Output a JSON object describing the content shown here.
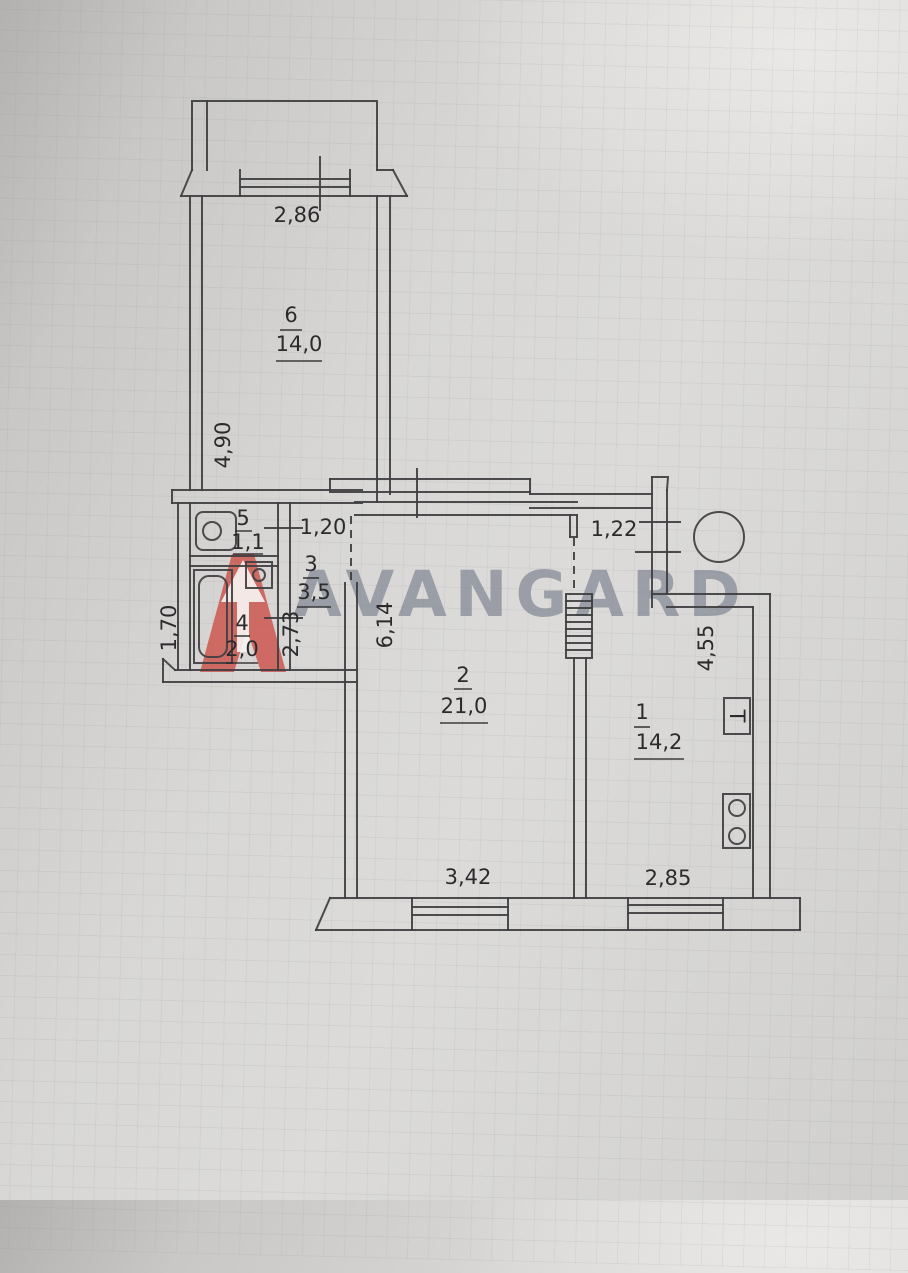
{
  "watermark": {
    "brand": "AVANGARD",
    "brand_color": "#7d8490",
    "logo": "avangard-a-arrow-logo",
    "logo_color": "#cb4b42"
  },
  "rooms": {
    "r1": {
      "number": "1",
      "area": "14,2"
    },
    "r2": {
      "number": "2",
      "area": "21,0"
    },
    "r3": {
      "number": "3",
      "area": "3,5"
    },
    "r4": {
      "number": "4",
      "area": "2,0"
    },
    "r5": {
      "number": "5",
      "area": "1,1"
    },
    "r6": {
      "number": "6",
      "area": "14,0"
    }
  },
  "dimensions": {
    "balcony_width": "2,86",
    "room6_depth": "4,90",
    "hall_width": "1,20",
    "hall_depth": "2,73",
    "bath_depth": "1,70",
    "room2_depth": "6,14",
    "room2_width": "3,42",
    "kitchen_opening": "1,22",
    "kitchen_depth": "4,55",
    "kitchen_width": "2,85"
  },
  "symbols": {
    "heater_label": "T"
  }
}
